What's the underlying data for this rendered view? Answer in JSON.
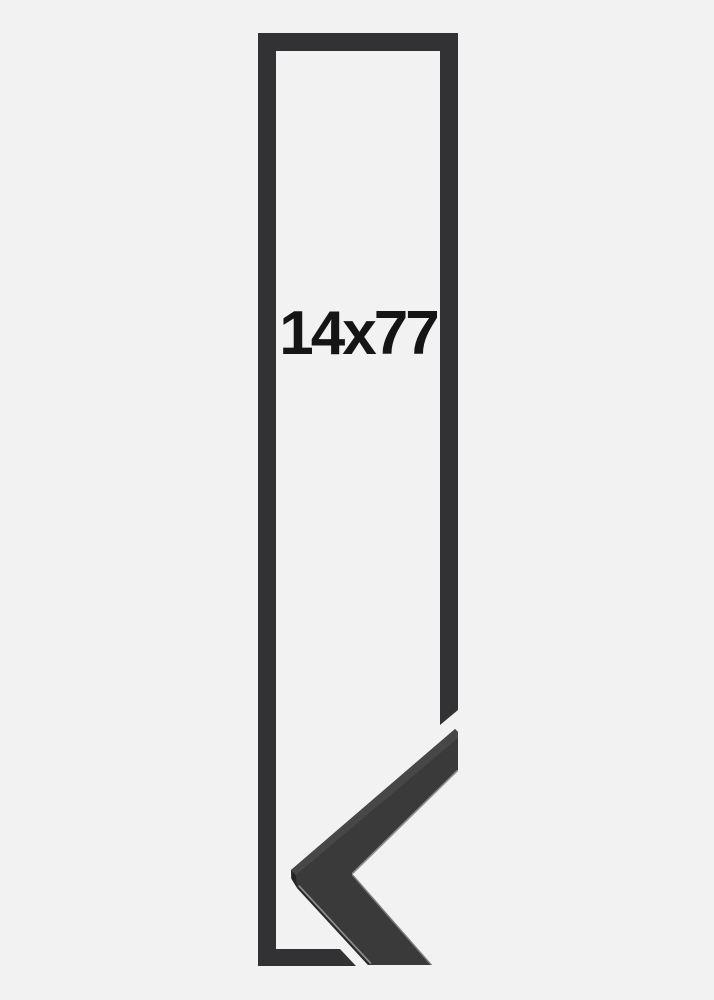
{
  "product_image": {
    "size_label": "14x77"
  },
  "graphics": {
    "frame_outline": "tall-rectangle-frame-outline",
    "corner_sample": "mitered-corner-moulding-chevron"
  },
  "colors": {
    "background": "#f2f2f2",
    "frame_outline": "#323234",
    "moulding_face": "#3a3a3a",
    "moulding_top_face": "#474747",
    "moulding_side_face": "#2a2a2a",
    "moulding_apex_facet": "#242424",
    "edge_highlight": "#8e8e8e",
    "edge_highlight_dim": "#7a7a7a",
    "label_text": "#151515"
  }
}
